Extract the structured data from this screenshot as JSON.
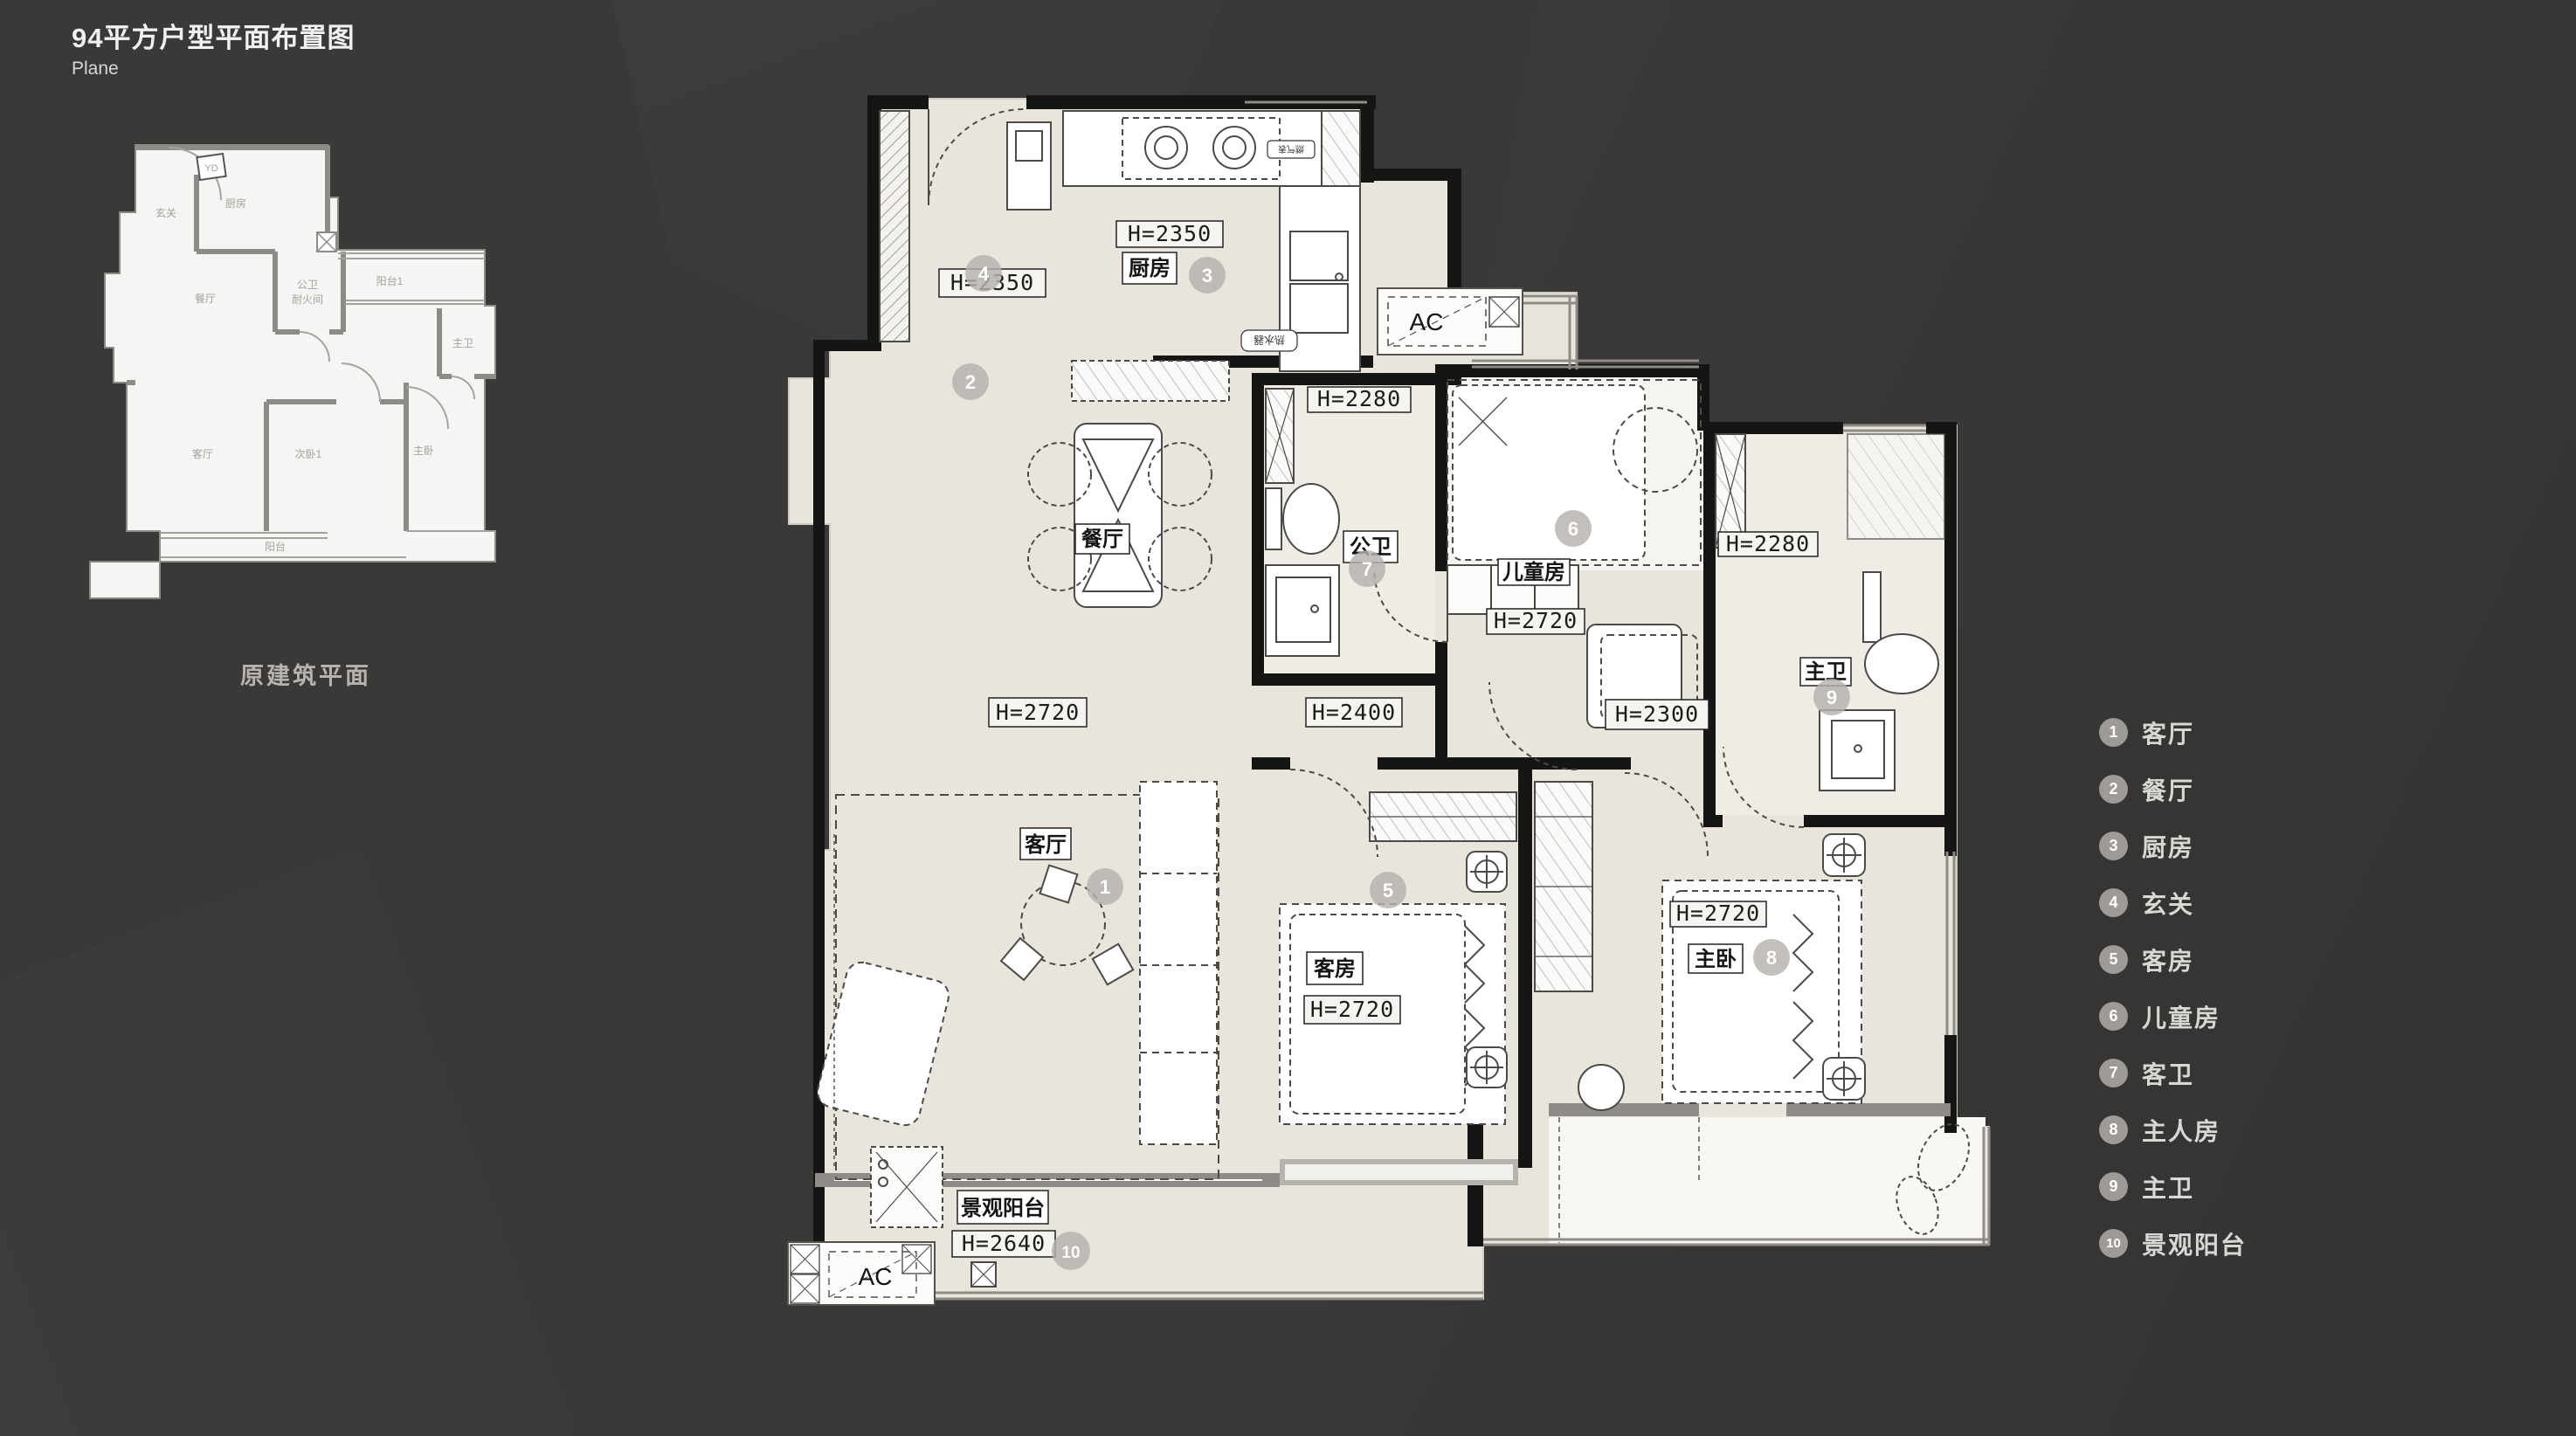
{
  "page": {
    "title": "94平方户型平面布置图",
    "subtitle": "Plane"
  },
  "original_plan": {
    "caption": "原建筑平面",
    "rooms": {
      "entry": "玄关",
      "kitchen": "厨房",
      "dining": "餐厅",
      "bath_line1": "公卫",
      "bath_line2": "耐火间",
      "balcony1": "阳台1",
      "master_bath": "主卫",
      "living": "客厅",
      "bedroom2": "次卧1",
      "master": "主卧",
      "balcony": "阳台",
      "meter_box": "YD"
    }
  },
  "plan": {
    "labels": {
      "entry_h": "H=2350",
      "kitchen": "厨房",
      "kitchen_h": "H=2350",
      "dining": "餐厅",
      "guest_bath": "公卫",
      "guest_bath_h": "H=2280",
      "kids": "儿童房",
      "kids_h": "H=2720",
      "master_bath": "主卫",
      "master_bath_h": "H=2280",
      "living": "客厅",
      "corridor_h_left": "H=2720",
      "corridor_h_mid": "H=2400",
      "corridor_h_right": "H=2300",
      "guest_room": "客房",
      "guest_room_h": "H=2720",
      "master": "主卧",
      "master_h": "H=2720",
      "balcony": "景观阳台",
      "balcony_h": "H=2640",
      "ac_top": "AC",
      "ac_bottom": "AC",
      "gas_meter": "燃气表",
      "water_heater": "热水器"
    },
    "numbers": {
      "n1": "1",
      "n2": "2",
      "n3": "3",
      "n4": "4",
      "n5": "5",
      "n6": "6",
      "n7": "7",
      "n8": "8",
      "n9": "9",
      "n10": "10"
    }
  },
  "legend": {
    "items": [
      {
        "num": "1",
        "label": "客厅"
      },
      {
        "num": "2",
        "label": "餐厅"
      },
      {
        "num": "3",
        "label": "厨房"
      },
      {
        "num": "4",
        "label": "玄关"
      },
      {
        "num": "5",
        "label": "客房"
      },
      {
        "num": "6",
        "label": "儿童房"
      },
      {
        "num": "7",
        "label": "客卫"
      },
      {
        "num": "8",
        "label": "主人房"
      },
      {
        "num": "9",
        "label": "主卫"
      },
      {
        "num": "10",
        "label": "景观阳台"
      }
    ]
  }
}
